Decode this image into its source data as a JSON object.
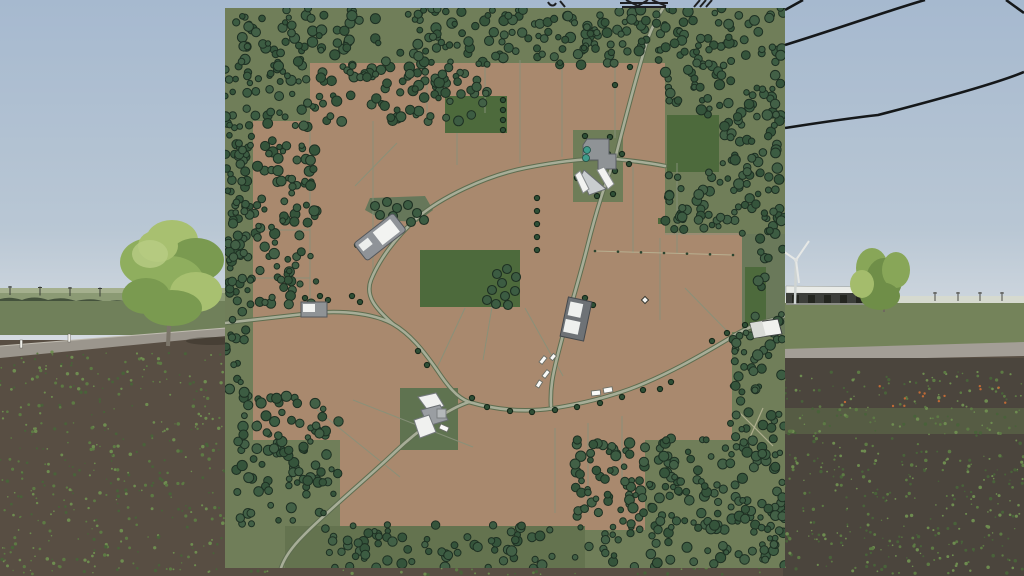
{
  "scene": {
    "sky": {
      "top": "#a6b9cf",
      "bottom": "#d8dde2",
      "horizon_y": 303
    },
    "left": {
      "far_field": "#a5b08e",
      "mid_field": "#8b9a74",
      "treeline": "#44523c",
      "green_field": "#70805a",
      "road": "#9b968d",
      "road_edge": "#c0bcb1",
      "soil": "#584e43",
      "pole_xs": [
        10,
        40,
        70,
        100,
        130,
        160,
        190
      ],
      "posts": [
        [
          20,
          340
        ],
        [
          68,
          334
        ]
      ]
    },
    "right": {
      "haze": "#d6dacf",
      "grass": "#74835a",
      "road": "#a39e96",
      "soil": "#4b453d",
      "ridge": "#5c6948",
      "flower_color": "#c06a36",
      "far_pole_xs": [
        935,
        958,
        980,
        1002
      ],
      "shed": {
        "x": 786,
        "y": 286,
        "w": 82,
        "roof": "#e9ebe7",
        "wall": "#3c3e3a",
        "base": "#8a8d84"
      },
      "turbine": {
        "x": 795,
        "hub_y": 260,
        "base_y": 304,
        "tower": "#cfd4d2",
        "blade": "#e6e8e6"
      }
    },
    "big_tree": {
      "trunk": "#7b7569",
      "blobs": [
        [
          172,
          240,
          26,
          20,
          0
        ],
        [
          150,
          262,
          30,
          24,
          1
        ],
        [
          196,
          260,
          28,
          22,
          2
        ],
        [
          170,
          282,
          34,
          26,
          1
        ],
        [
          146,
          296,
          24,
          18,
          2
        ],
        [
          196,
          292,
          26,
          20,
          0
        ],
        [
          172,
          308,
          30,
          18,
          2
        ],
        [
          158,
          246,
          20,
          16,
          0
        ]
      ],
      "greens": [
        "#a8c070",
        "#8fae5e",
        "#7a9a50"
      ],
      "trunk_path": "M168,346 L170,300"
    },
    "right_trees": {
      "blobs": [
        [
          872,
          268,
          16,
          20,
          1
        ],
        [
          884,
          280,
          18,
          22,
          2
        ],
        [
          896,
          270,
          14,
          18,
          1
        ],
        [
          880,
          296,
          20,
          14,
          2
        ],
        [
          862,
          284,
          12,
          14,
          0
        ]
      ],
      "greens": [
        "#a4bc6c",
        "#88a658",
        "#6f8e48"
      ]
    },
    "cables": [
      "M785,45 C840,28 890,10 925,0",
      "M785,128 C830,121 860,117 878,115 C940,99 1000,82 1024,72",
      "M785,10 L803,0",
      "M1006,0 L1024,13"
    ],
    "cable_color": "#15181a",
    "pylon_bits": [
      "M548,2 C550,6 554,7 556,3",
      "M560,1 L565,7",
      "M620,3 L668,3",
      "M622,7 L666,7",
      "M626,0 L640,7",
      "M648,0 L636,7",
      "M652,0 L666,6",
      "M694,7 L700,0",
      "M700,7 L706,0",
      "M706,7 L712,0"
    ],
    "speck_colors": [
      "#5d7a44",
      "#6e8c50",
      "#49623a"
    ],
    "speck_regions": [
      [
        0,
        352,
        225,
        222,
        420,
        11
      ],
      [
        783,
        370,
        241,
        204,
        460,
        22
      ],
      [
        225,
        566,
        560,
        9,
        40,
        33
      ]
    ],
    "flower_region": [
      830,
      386,
      180,
      20,
      14,
      44
    ]
  },
  "map": {
    "x": 225,
    "y": 8,
    "size": 560,
    "palette": {
      "ground": "#707e59",
      "brown": "#a9896e",
      "green_field": "#4d6a3c",
      "boundary": "#87917a",
      "road_casing": "#5e6d50",
      "road_fill": "#a7ad97",
      "path_tan": "#bcb898",
      "tree_fills": [
        "#3c5c42",
        "#35543b",
        "#426046"
      ],
      "tree_stroke": "#1e3023",
      "lone_tree": "#2f4f36",
      "lone_tree_stroke": "#17281a",
      "bld_gray": "#8f9396",
      "bld_dark": "#6e7276",
      "bld_white": "#f2f3f1",
      "bld_stroke": "#4b4f53",
      "silo_teal": "#3f9b8b",
      "vehicle": "#fafaf8",
      "vehicle_stroke": "#6a6e66"
    },
    "brown_fields": [
      [
        85,
        55,
        355,
        60
      ],
      [
        28,
        113,
        412,
        114
      ],
      [
        28,
        225,
        492,
        99
      ],
      [
        28,
        322,
        479,
        110
      ],
      [
        115,
        430,
        305,
        92
      ]
    ],
    "green_fields": [
      [
        442,
        107,
        52,
        57
      ],
      [
        220,
        88,
        62,
        37
      ],
      [
        195,
        242,
        100,
        57
      ],
      [
        520,
        259,
        21,
        63
      ],
      [
        433,
        210,
        6,
        6
      ]
    ],
    "olive_patches": [
      {
        "r": [
          348,
          122,
          50,
          72
        ],
        "f": "#6e7d58"
      },
      {
        "r": [
          175,
          380,
          58,
          62
        ],
        "f": "#5f7350"
      },
      {
        "r": [
          60,
          518,
          300,
          42
        ],
        "f": "#64734f"
      },
      {
        "r": [
          517,
          226,
          43,
          100
        ],
        "f": "#6a795a"
      }
    ],
    "patch_polys": [
      {
        "pts": [
          [
            145,
            190
          ],
          [
            200,
            188
          ],
          [
            208,
            202
          ],
          [
            192,
            214
          ],
          [
            158,
            212
          ],
          [
            140,
            202
          ]
        ],
        "f": "#66775a"
      }
    ],
    "boundaries": [
      [
        85,
        115,
        85,
        302
      ],
      [
        148,
        113,
        148,
        272
      ],
      [
        202,
        55,
        202,
        109
      ],
      [
        260,
        55,
        260,
        105
      ],
      [
        295,
        52,
        295,
        155
      ],
      [
        337,
        52,
        337,
        149
      ],
      [
        390,
        55,
        390,
        130
      ],
      [
        408,
        159,
        408,
        245
      ],
      [
        452,
        155,
        452,
        245
      ],
      [
        435,
        230,
        435,
        312
      ],
      [
        28,
        222,
        85,
        222
      ],
      [
        28,
        270,
        85,
        270
      ],
      [
        130,
        178,
        172,
        135
      ],
      [
        232,
        125,
        232,
        157
      ],
      [
        267,
        299,
        258,
        352
      ],
      [
        240,
        300,
        212,
        360
      ],
      [
        300,
        300,
        338,
        368
      ],
      [
        330,
        420,
        330,
        505
      ],
      [
        363,
        415,
        363,
        505
      ],
      [
        397,
        408,
        397,
        472
      ],
      [
        92,
        402,
        175,
        469
      ],
      [
        128,
        392,
        248,
        439
      ],
      [
        440,
        226,
        518,
        226
      ],
      [
        460,
        280,
        505,
        326
      ]
    ],
    "dotted_line": {
      "x1": 370,
      "y1": 243,
      "x2": 508,
      "y2": 247,
      "dots": 7
    },
    "roads": [
      "M0,315 L88,305 C120,302 150,306 168,316 C185,326 198,342 212,362 C222,377 232,390 244,394",
      "M244,394 C275,403 305,404 330,400 C355,396 380,390 405,381 C440,368 475,348 505,330 C515,323 528,318 538,314 L560,308",
      "M244,394 C225,400 195,420 170,444 C145,468 100,505 78,528 C68,538 60,548 56,560",
      "M168,316 C150,300 140,288 146,272 C154,252 170,230 192,210 C215,190 260,168 300,160 C340,152 370,150 390,151",
      "M390,151 C398,120 408,80 420,40 C425,22 432,10 438,0",
      "M390,151 C382,170 372,200 362,240 C354,272 342,310 332,350 C328,366 325,380 326,398",
      "M390,151 C410,153 425,155 440,158"
    ],
    "faint_paths": [
      "M515,405 L548,438",
      "M538,400 L522,436"
    ],
    "forest_regions": [
      [
        0,
        0,
        92,
        302,
        210,
        1
      ],
      [
        92,
        0,
        170,
        114,
        150,
        2
      ],
      [
        262,
        0,
        178,
        57,
        95,
        3
      ],
      [
        440,
        0,
        120,
        108,
        100,
        4
      ],
      [
        494,
        106,
        66,
        120,
        62,
        5
      ],
      [
        440,
        164,
        56,
        62,
        34,
        6
      ],
      [
        530,
        196,
        30,
        132,
        22,
        7
      ],
      [
        505,
        324,
        55,
        108,
        42,
        8
      ],
      [
        350,
        430,
        210,
        130,
        225,
        9
      ],
      [
        92,
        516,
        240,
        44,
        70,
        10
      ],
      [
        10,
        388,
        104,
        128,
        100,
        12
      ],
      [
        0,
        114,
        26,
        274,
        46,
        13
      ]
    ],
    "tree_clusters": [
      [
        272,
        266
      ],
      [
        282,
        261
      ],
      [
        291,
        269
      ],
      [
        277,
        275
      ],
      [
        267,
        282
      ],
      [
        280,
        288
      ],
      [
        290,
        283
      ],
      [
        271,
        296
      ],
      [
        283,
        297
      ],
      [
        262,
        292
      ],
      [
        150,
        198
      ],
      [
        162,
        194
      ],
      [
        172,
        200
      ],
      [
        183,
        197
      ],
      [
        192,
        205
      ],
      [
        199,
        212
      ],
      [
        186,
        214
      ],
      [
        168,
        208
      ],
      [
        155,
        207
      ]
    ],
    "roadside_trees": [
      [
        278,
        92
      ],
      [
        278,
        102
      ],
      [
        278,
        112
      ],
      [
        278,
        122
      ],
      [
        312,
        190
      ],
      [
        312,
        203
      ],
      [
        312,
        216
      ],
      [
        312,
        229
      ],
      [
        312,
        242
      ],
      [
        262,
        399
      ],
      [
        285,
        403
      ],
      [
        307,
        404
      ],
      [
        330,
        402
      ],
      [
        352,
        399
      ],
      [
        375,
        395
      ],
      [
        397,
        389
      ],
      [
        418,
        382
      ],
      [
        193,
        343
      ],
      [
        202,
        357
      ],
      [
        127,
        288
      ],
      [
        135,
        294
      ],
      [
        383,
        146
      ],
      [
        397,
        146
      ],
      [
        404,
        156
      ],
      [
        390,
        163
      ],
      [
        376,
        158
      ],
      [
        405,
        59
      ],
      [
        390,
        77
      ],
      [
        502,
        325
      ],
      [
        520,
        317
      ],
      [
        487,
        333
      ],
      [
        360,
        290
      ],
      [
        368,
        297
      ],
      [
        343,
        315
      ],
      [
        80,
        290
      ],
      [
        95,
        288
      ],
      [
        103,
        292
      ],
      [
        360,
        128
      ],
      [
        385,
        129
      ],
      [
        352,
        170
      ],
      [
        372,
        188
      ],
      [
        388,
        186
      ],
      [
        132,
        237
      ],
      [
        435,
        381
      ],
      [
        446,
        374
      ],
      [
        247,
        390
      ]
    ],
    "buildings": [
      {
        "name": "building-main-farm",
        "shapes": [
          {
            "t": "p",
            "pts": [
              [
                362,
                131
              ],
              [
                384,
                131
              ],
              [
                384,
                146
              ],
              [
                391,
                146
              ],
              [
                391,
                161
              ],
              [
                373,
                161
              ],
              [
                373,
                152
              ],
              [
                358,
                152
              ],
              [
                358,
                137
              ]
            ],
            "f": "#8f9396",
            "s": "#5a5e62"
          },
          {
            "t": "p",
            "pts": [
              [
                359,
                162
              ],
              [
                381,
                181
              ],
              [
                364,
                187
              ],
              [
                356,
                168
              ]
            ],
            "f": "#c9cdcf",
            "s": "#6a6e72"
          },
          {
            "t": "p",
            "pts": [
              [
                379,
                159
              ],
              [
                389,
                176
              ],
              [
                383,
                181
              ],
              [
                372,
                162
              ]
            ],
            "f": "#f2f3f1",
            "s": "#8a8e90"
          },
          {
            "t": "p",
            "pts": [
              [
                355,
                163
              ],
              [
                364,
                181
              ],
              [
                358,
                185
              ],
              [
                350,
                167
              ]
            ],
            "f": "#f2f3f1",
            "s": "#8a8e90"
          }
        ],
        "circles": [
          [
            362,
            142,
            3.5,
            "#3f9b8b"
          ],
          [
            361,
            150,
            3.5,
            "#3f9b8b"
          ]
        ]
      },
      {
        "name": "building-diagonal-barn",
        "rot": [
          -38,
          155,
          229
        ],
        "shapes": [
          {
            "t": "r",
            "r": [
              130,
              218,
              50,
              22
            ],
            "rx": 3,
            "f": "#8f9398",
            "s": "#53575b"
          },
          {
            "t": "r",
            "r": [
              152,
              221,
              22,
              16
            ],
            "f": "#f2f3f1"
          },
          {
            "t": "r",
            "r": [
              133,
              222,
              12,
              8
            ],
            "f": "#eceeec"
          }
        ]
      },
      {
        "name": "building-roadside-small",
        "shapes": [
          {
            "t": "r",
            "r": [
              76,
              294,
              26,
              15
            ],
            "f": "#8f9396",
            "s": "#55585c"
          },
          {
            "t": "r",
            "r": [
              78,
              296,
              12,
              8
            ],
            "f": "#f2f3f1"
          }
        ]
      },
      {
        "name": "building-mid-east",
        "rot": [
          12,
          351,
          311
        ],
        "shapes": [
          {
            "t": "r",
            "r": [
              339,
              291,
              24,
              40
            ],
            "f": "#6e7276",
            "s": "#44484c"
          },
          {
            "t": "r",
            "r": [
              342,
              295,
              13,
              14
            ],
            "f": "#eef0ee"
          },
          {
            "t": "r",
            "r": [
              341,
              313,
              15,
              13
            ],
            "f": "#eef0ee"
          }
        ]
      },
      {
        "name": "building-south-cluster",
        "shapes": [
          {
            "t": "p",
            "pts": [
              [
                193,
                389
              ],
              [
                211,
                385
              ],
              [
                219,
                398
              ],
              [
                204,
                404
              ]
            ],
            "f": "#f0f1ef",
            "s": "#75797d"
          },
          {
            "t": "p",
            "pts": [
              [
                196,
                402
              ],
              [
                215,
                397
              ],
              [
                223,
                412
              ],
              [
                203,
                418
              ]
            ],
            "f": "#9a9ea2",
            "s": "#6a6e72"
          },
          {
            "t": "p",
            "pts": [
              [
                189,
                412
              ],
              [
                204,
                407
              ],
              [
                211,
                424
              ],
              [
                195,
                430
              ]
            ],
            "f": "#f0f1ef",
            "s": "#75797d"
          },
          {
            "t": "r",
            "r": [
              212,
              401,
              9,
              9
            ],
            "f": "#b4b8ba",
            "s": "#7a7e80"
          }
        ]
      },
      {
        "name": "building-east-barn",
        "shapes": [
          {
            "t": "p",
            "pts": [
              [
                525,
                315
              ],
              [
                553,
                311
              ],
              [
                557,
                326
              ],
              [
                529,
                330
              ]
            ],
            "f": "#f0f1ee",
            "s": "#3e4242"
          },
          {
            "t": "p",
            "pts": [
              [
                525,
                315
              ],
              [
                537,
                313
              ],
              [
                541,
                328
              ],
              [
                529,
                330
              ]
            ],
            "f": "#d9dbd7"
          }
        ]
      }
    ],
    "vehicles": [
      [
        318,
        352,
        8,
        4,
        -52
      ],
      [
        321,
        366,
        8,
        4,
        -52
      ],
      [
        314,
        376,
        7,
        4,
        -58
      ],
      [
        328,
        349,
        6,
        4,
        -50
      ],
      [
        371,
        385,
        9,
        5,
        -6
      ],
      [
        383,
        382,
        9,
        5,
        -10
      ],
      [
        219,
        420,
        9,
        5,
        24
      ]
    ],
    "diamond_marker": [
      420,
      292
    ]
  }
}
